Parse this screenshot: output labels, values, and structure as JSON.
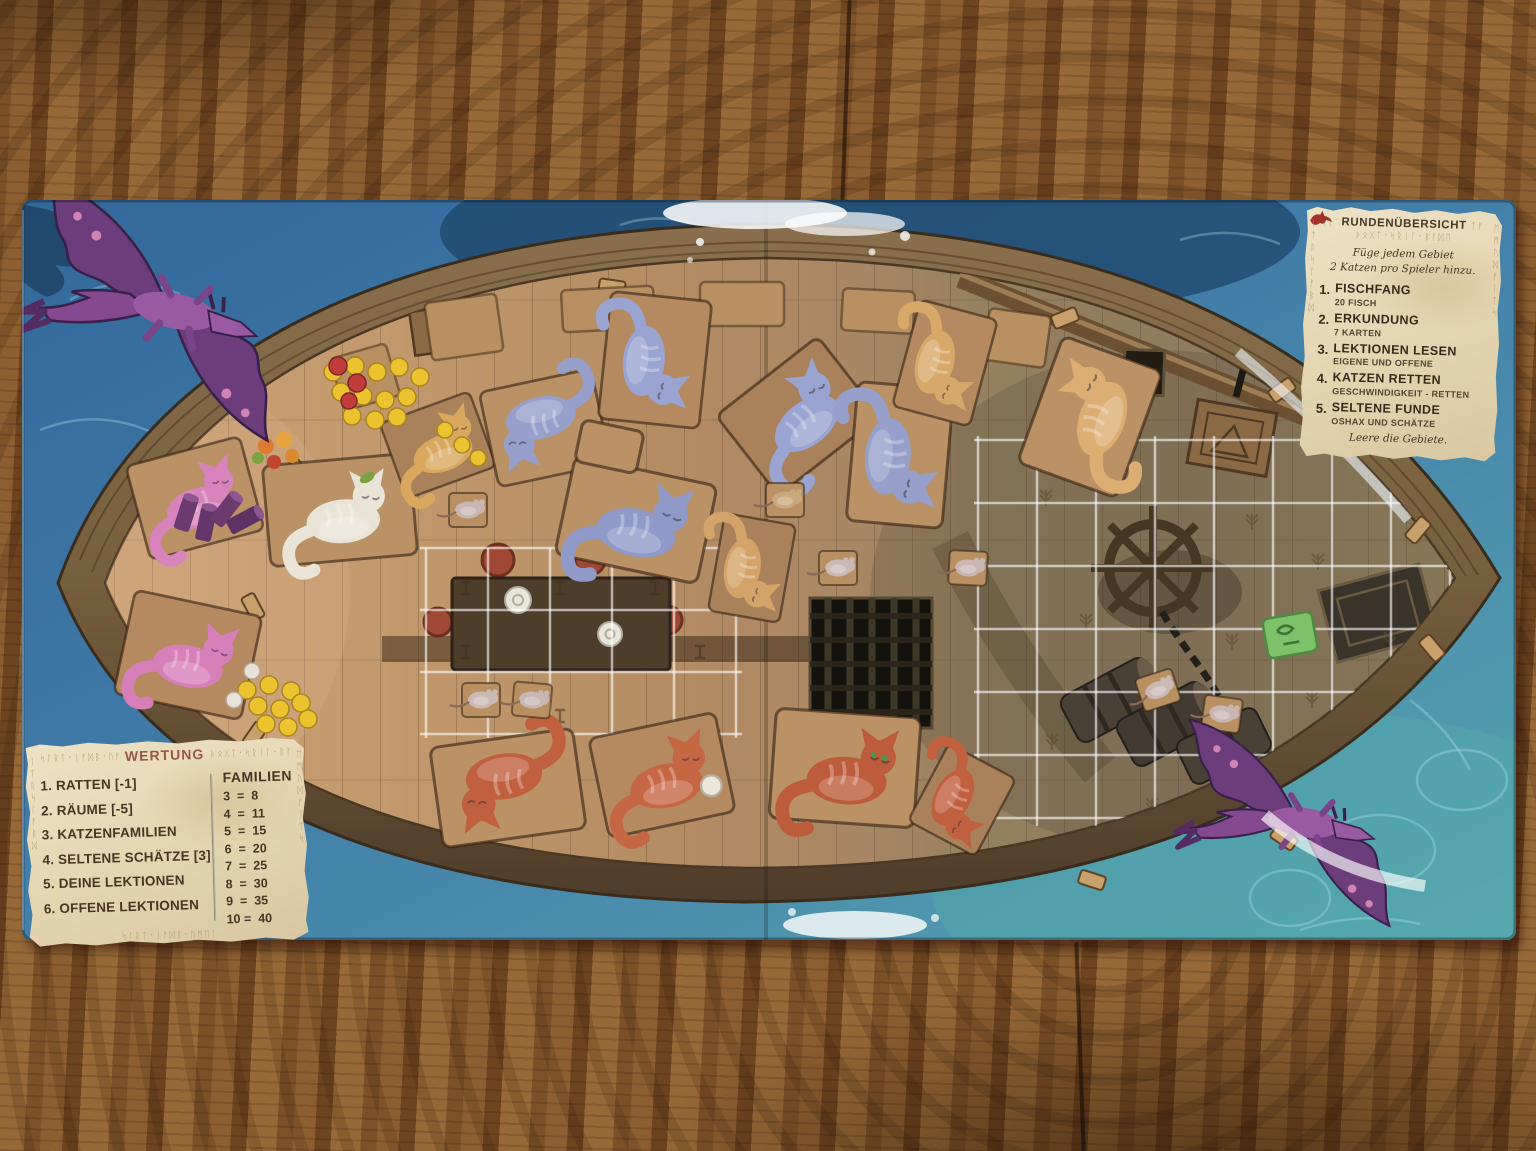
{
  "round_panel": {
    "title": "RUNDENÜBERSICHT",
    "intro_line1": "Füge jedem Gebiet",
    "intro_line2": "2 Katzen pro Spieler hinzu.",
    "phases": [
      {
        "num": "1.",
        "title": "FISCHFANG",
        "sub": "20 FISCH"
      },
      {
        "num": "2.",
        "title": "ERKUNDUNG",
        "sub": "7 KARTEN"
      },
      {
        "num": "3.",
        "title": "LEKTIONEN LESEN",
        "sub": "EIGENE UND OFFENE"
      },
      {
        "num": "4.",
        "title": "KATZEN RETTEN",
        "sub": "GESCHWINDIGKEIT - RETTEN"
      },
      {
        "num": "5.",
        "title": "SELTENE FUNDE",
        "sub": "OSHAX UND SCHÄTZE"
      }
    ],
    "footer": "Leere die Gebiete."
  },
  "scoring_panel": {
    "title": "WERTUNG",
    "items": [
      "1. RATTEN [-1]",
      "2. RÄUME [-5]",
      "3. KATZENFAMILIEN",
      "4. SELTENE SCHÄTZE [3]",
      "5. DEINE LEKTIONEN",
      "6. OFFENE LEKTIONEN"
    ],
    "familien_title": "FAMILIEN",
    "familien_rows": [
      "3  =  8",
      "4  =  11",
      "5  =  15",
      "6  =  20",
      "7  =  25",
      "8  =  30",
      "9  =  35",
      "10 =  40"
    ]
  },
  "decor": {
    "runes_a": "ᛋᛚᚱᛏ᛫ᛁᚠᛞᛒ᛫ᚢᛗᛖᛚ",
    "runes_b": "ᚦᛟᚷᛏ᛫ᛋᚱᛁᛚ᛫ᛒᚠᛞᛖ",
    "runes_side_l": "ᛁᛏᚱᛋᛚᚠᛒᛞ",
    "runes_side_r": "ᛖᛗᚢᛞᚠᛁᛏᛋ",
    "runes_short": "ᛋᛁᛏᚱ",
    "runes_short2": "ᛏᚠᛁᛋ"
  },
  "palette": {
    "water_blue": "#3d77a6",
    "water_teal": "#57b0a8",
    "deck_wood": "#b48c63",
    "hull_wood": "#5c4733",
    "parchment": "#e7dabe",
    "ink": "#3b2d1e",
    "title_red": "#9b544a",
    "blue_cat": "#96a0cb",
    "pink_cat": "#d983bd",
    "orange_cat": "#c0603e",
    "tan_cat": "#d8a868",
    "oshax_white": "#e9e4d6",
    "fish_token": "#ecc32f",
    "treasure_green": "#7dc169",
    "dragon_purple": "#6b3d7a"
  }
}
